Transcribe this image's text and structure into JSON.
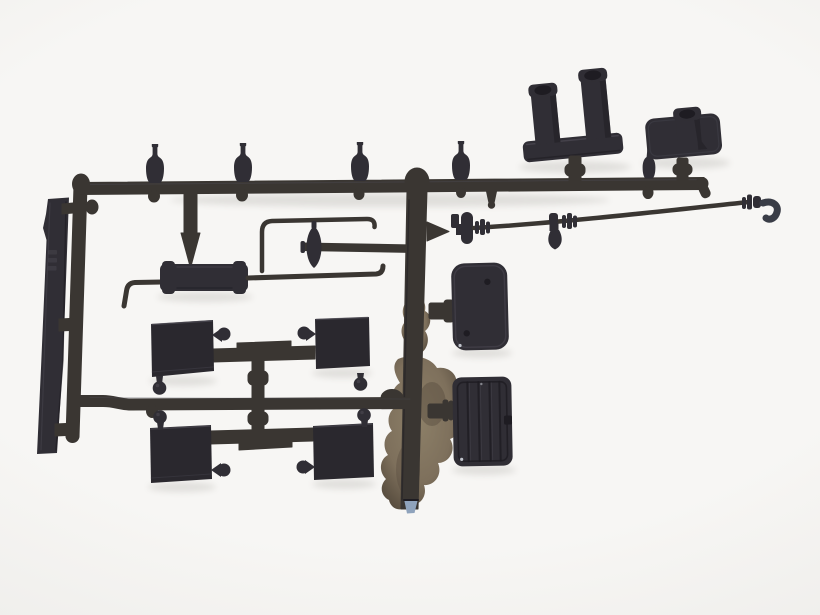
{
  "scene": {
    "subject": "Photograph of a dark grey injection-moulded plastic model kit sprue (parts tree) with truck accessory parts, laid on a plain light studio background",
    "background": "plain warm-white backdrop with soft vignette",
    "material": "dark grey styrene plastic with faint sheen"
  },
  "colors": {
    "bg-center": "#f7f6f4",
    "bg-mid": "#efeeeb",
    "bg-edge": "#e2e0dd",
    "plastic": "#302e35",
    "plastic-2": "#2a282e",
    "plastic-deep": "#1e1c22",
    "plastic-hi": "#514e58",
    "runner": "#3a3632",
    "runner-hi": "#5a544c",
    "flash": "#7e705c",
    "flash-light": "#8d8068",
    "flash-dark": "#574c3e",
    "cut-mark": "#8fa3bc",
    "shadow": "#6b675f",
    "glint": "#d9dee6"
  },
  "parts": [
    {
      "id": "left-flat-bar",
      "label": "flat chassis bar with notches and faint embossed marks"
    },
    {
      "id": "left-runner",
      "label": "left vertical round runner with rounded foot"
    },
    {
      "id": "top-runner",
      "label": "top horizontal runner with rounded left knob"
    },
    {
      "id": "bottom-runner",
      "label": "lower horizontal runner"
    },
    {
      "id": "center-runner",
      "label": "central vertical runner with domed head and cut tip"
    },
    {
      "id": "bottle-fittings",
      "label": "four bottle-shaped fittings standing on top runner",
      "count": 4
    },
    {
      "id": "spike-fitting",
      "label": "spiked cone fitting on top runner"
    },
    {
      "id": "twin-post-mount",
      "label": "mounting plate with two hollow square posts"
    },
    {
      "id": "single-post-mount",
      "label": "mounting plate with one hollow square post"
    },
    {
      "id": "long-rod",
      "label": "long thin rod with ring couplers rising to the right"
    },
    {
      "id": "elbow-tip",
      "label": "curved elbow tip at right end of long rod"
    },
    {
      "id": "teardrop-coupler",
      "label": "coupler with hanging teardrop valve"
    },
    {
      "id": "flanged-coupler",
      "label": "flanged coupler block near central runner"
    },
    {
      "id": "air-tank",
      "label": "cylindrical air tank with banded ends"
    },
    {
      "id": "bent-pipe",
      "label": "short pipe with 90-degree downward bend"
    },
    {
      "id": "handrail-rod",
      "label": "J-shaped handrail rod"
    },
    {
      "id": "straight-rod",
      "label": "straight rod with upturned hooked tip"
    },
    {
      "id": "cross-fitting",
      "label": "cross fitting with lens-shaped hub"
    },
    {
      "id": "mudflap-pair-upper",
      "label": "pair of mud flap plates joined by a bar, teardrop and ball knobs"
    },
    {
      "id": "mudflap-pair-lower",
      "label": "mirrored pair of mud flap plates joined by a bar"
    },
    {
      "id": "smooth-box",
      "label": "rounded box lid with two small holes"
    },
    {
      "id": "ribbed-box",
      "label": "ribbed battery box with side notch"
    },
    {
      "id": "flash-residue",
      "label": "tan mould-flash residue behind lower central runner"
    },
    {
      "id": "cut-tip",
      "label": "pale blue cut mark at bottom tip of central runner"
    }
  ]
}
